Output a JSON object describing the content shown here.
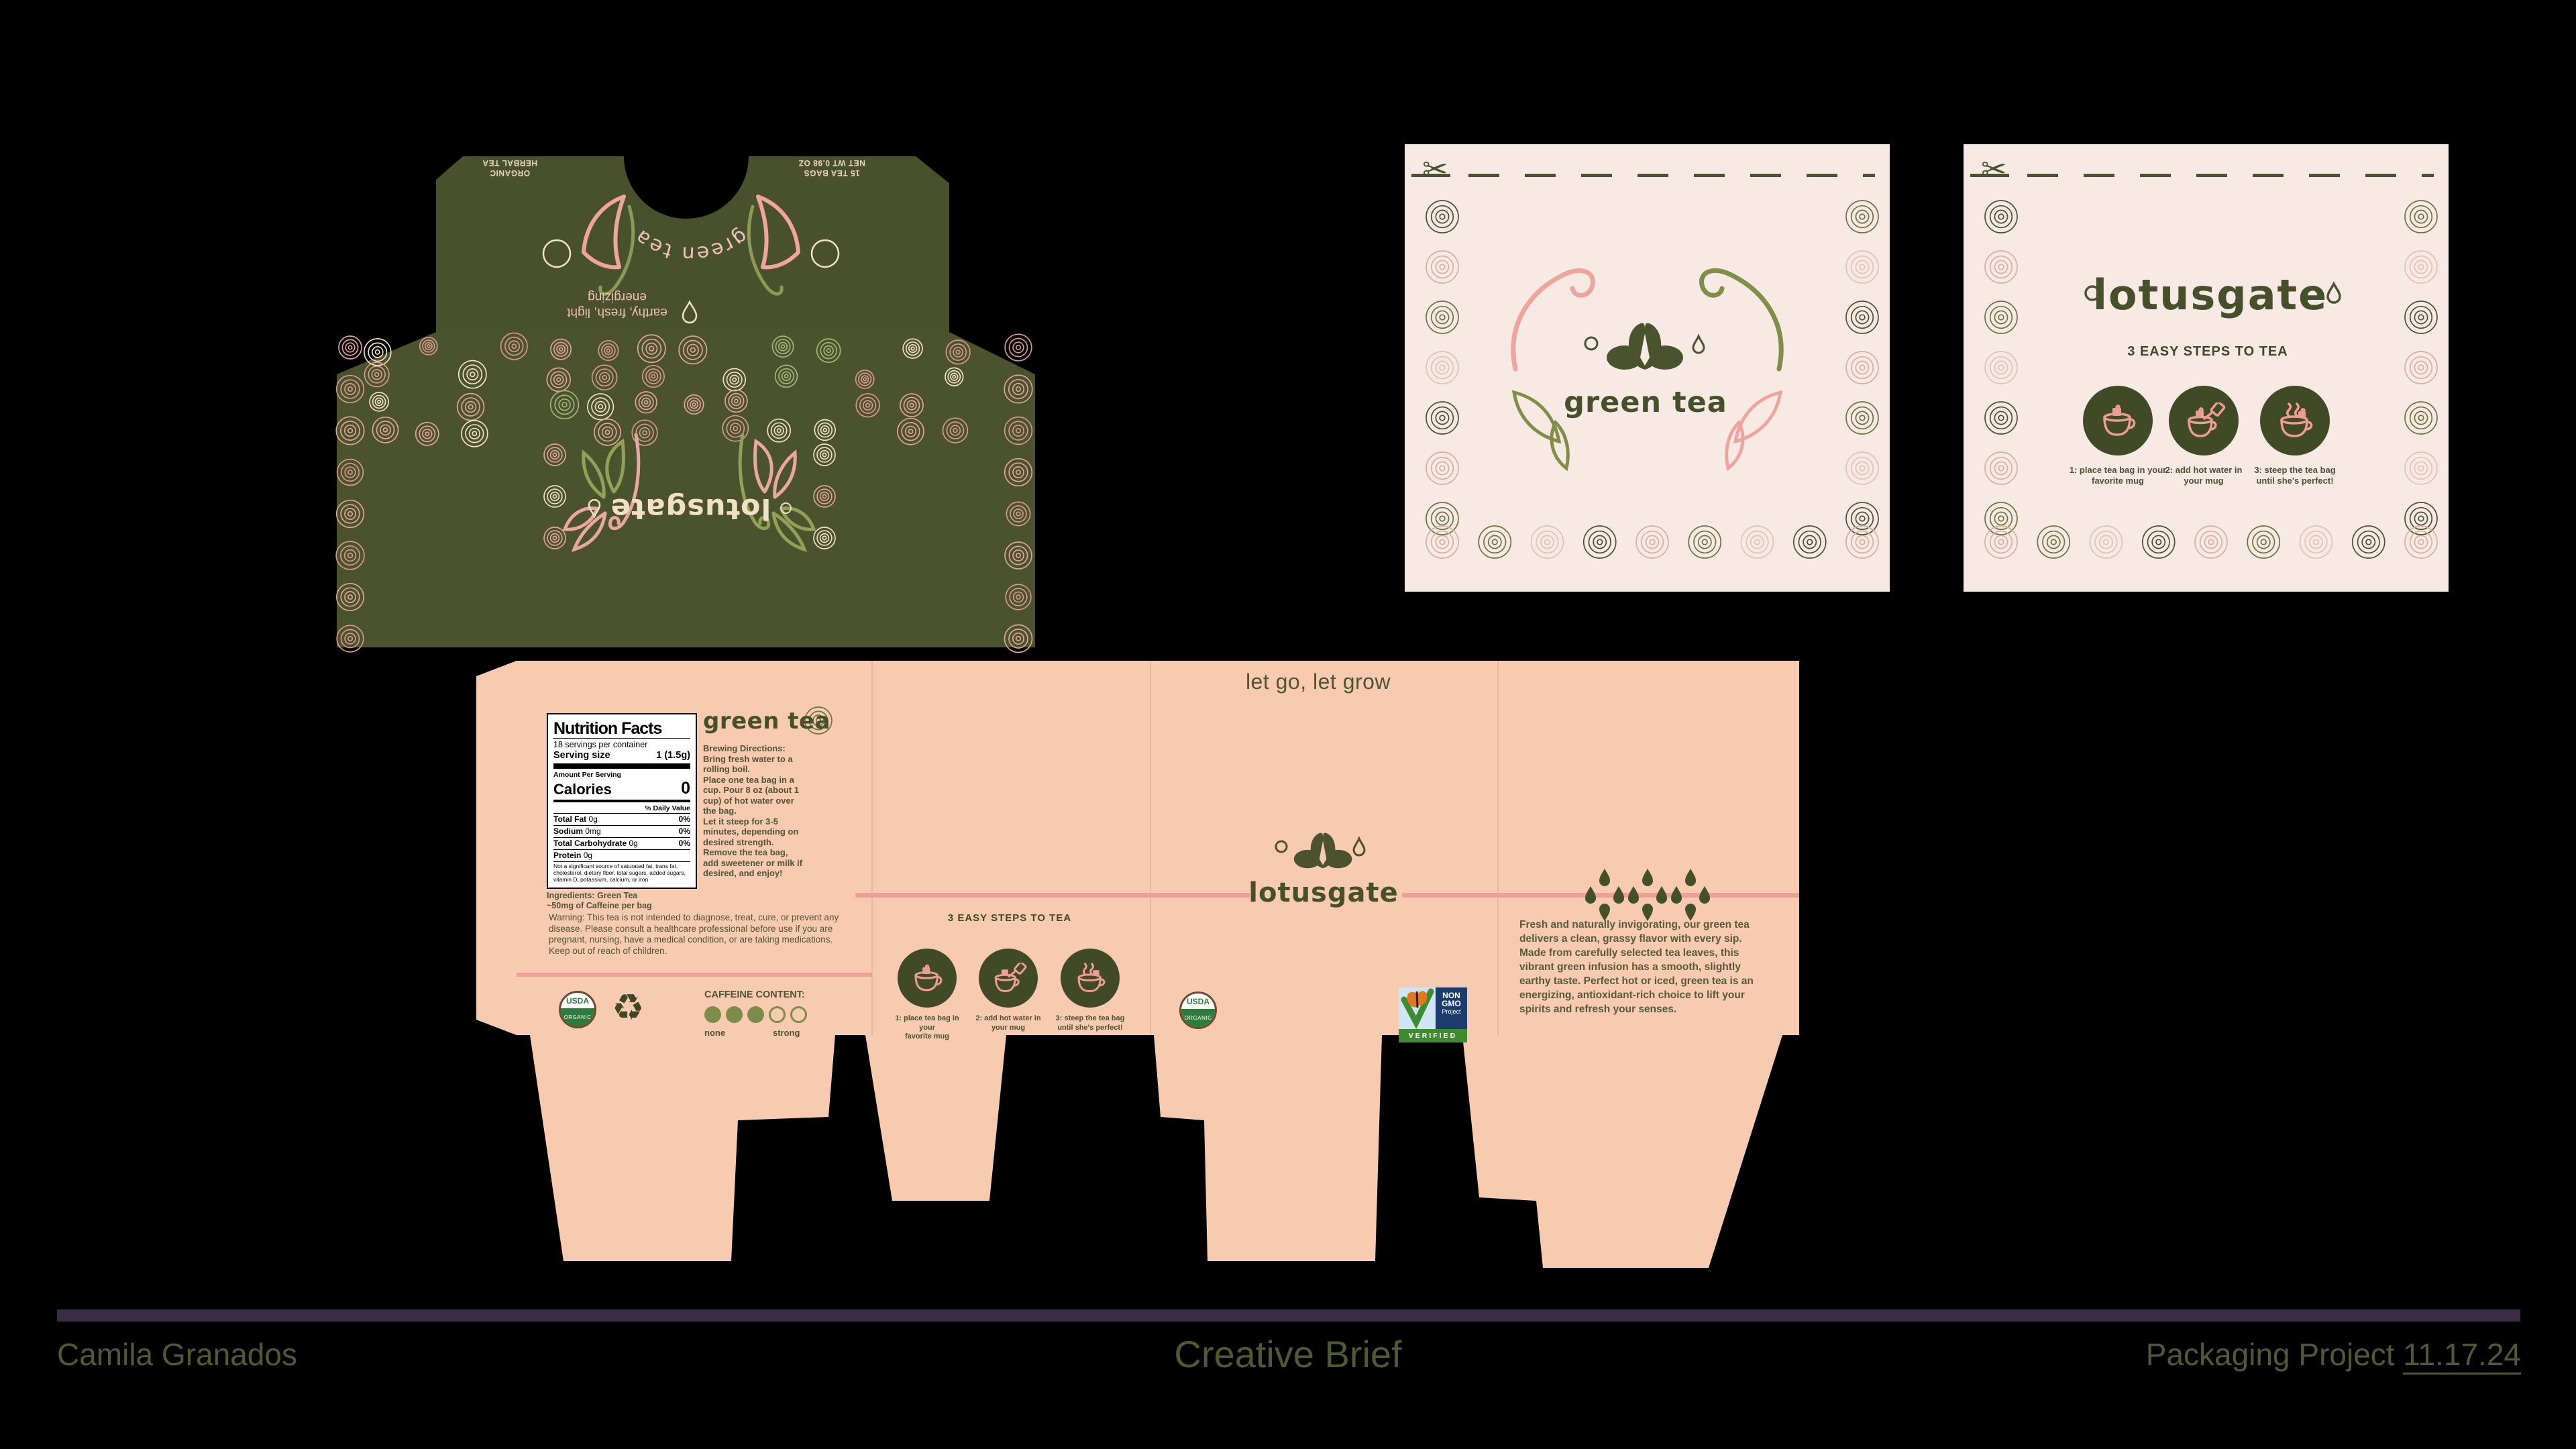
{
  "footer": {
    "author": "Camila Granados",
    "title": "Creative Brief",
    "project": "Packaging Project",
    "date": "11.17.24"
  },
  "brand": {
    "logo": "lotusgate",
    "product": "green tea",
    "slogan": "let go, let grow"
  },
  "green_box": {
    "flap_left": "ORGANIC\nHERBAL TEA",
    "flap_right": "15 TEA BAGS\nNET WT 0.98 OZ",
    "brand": "green tea",
    "tagline": "earthy, fresh, light\nenergizing",
    "logo": "lotusgate"
  },
  "panel_front": {
    "brand": "green tea"
  },
  "panel_back": {
    "logo": "lotusgate"
  },
  "steps": {
    "heading": "3 EASY STEPS TO TEA",
    "items": [
      {
        "caption": "1: place tea bag in your\nfavorite mug"
      },
      {
        "caption": "2: add hot water in\nyour mug"
      },
      {
        "caption": "3: steep the tea bag\nuntil she's perfect!"
      }
    ]
  },
  "nutrition": {
    "title": "Nutrition Facts",
    "servings": "18 servings per container",
    "serving_size_label": "Serving size",
    "serving_size_value": "1 (1.5g)",
    "amount_label": "Amount Per Serving",
    "calories_label": "Calories",
    "calories_value": "0",
    "dv_label": "% Daily Value",
    "rows": [
      {
        "name": "Total Fat",
        "amount": "0g",
        "dv": "0%"
      },
      {
        "name": "Sodium",
        "amount": "0mg",
        "dv": "0%"
      },
      {
        "name": "Total Carbohydrate",
        "amount": "0g",
        "dv": "0%"
      },
      {
        "name": "Protein",
        "amount": "0g",
        "dv": ""
      }
    ],
    "footnote": "Not a significant source of saturated fat, trans fat, cholesterol, dietary fiber, total sugars, added sugars, vitamin D, potassium, calcium, or iron",
    "ingredients": "Ingredients: Green Tea",
    "caffeine_note": "~50mg of Caffeine per bag"
  },
  "brewing": {
    "title": "Brewing Directions:",
    "body": "Bring fresh water to a\nrolling boil.\nPlace one tea bag in a\ncup. Pour 8 oz (about 1\ncup) of hot water over\nthe bag.\nLet it steep for 3-5\nminutes, depending on\ndesired strength.\nRemove the tea bag,\nadd sweetener or milk if\ndesired, and enjoy!"
  },
  "warning": "Warning: This tea is not intended to diagnose, treat, cure, or prevent any disease. Please consult a healthcare professional before use if you are pregnant, nursing, have a medical condition, or are taking medications. Keep out of reach of children.",
  "caffeine_meter": {
    "label": "CAFFEINE CONTENT:",
    "min": "none",
    "max": "strong",
    "filled": 3,
    "total": 5
  },
  "description": "Fresh and naturally invigorating, our green tea delivers a clean, grassy flavor with every sip. Made from carefully selected tea leaves, this vibrant green infusion has a smooth, slightly earthy taste. Perfect hot or iced, green tea is an energizing, antioxidant-rich choice to lift your spirits and refresh your senses.",
  "badges": {
    "usda_top": "USDA",
    "usda_bottom": "ORGANIC",
    "non_gmo_l1": "NON",
    "non_gmo_l2": "GMO",
    "non_gmo_l3": "Project",
    "verified": "VERIFIED"
  },
  "colors": {
    "olive": "#4a522e",
    "peach": "#f8cbb0",
    "blush": "#f7e9e3",
    "pink": "#ef9f9a",
    "cream": "#f2e3c8",
    "plum": "#3a2b47"
  }
}
